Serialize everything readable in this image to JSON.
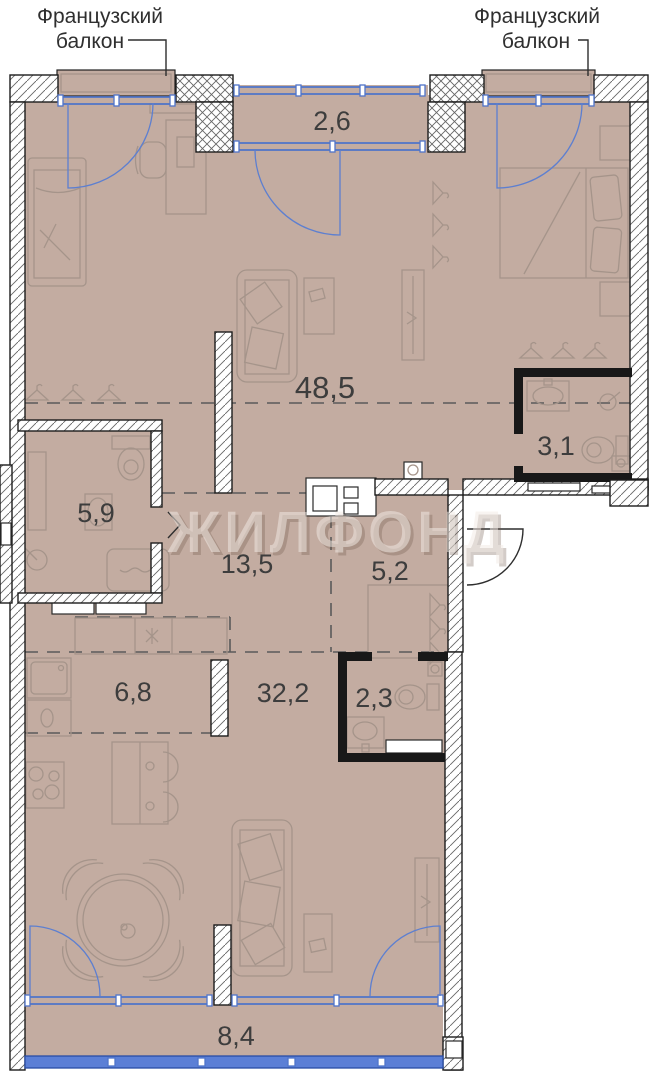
{
  "watermark": {
    "text": "ЖИЛФОНД"
  },
  "balcony_label_left": {
    "line1": "Французский",
    "line2": "балкон"
  },
  "balcony_label_right": {
    "line1": "Французский",
    "line2": "балкон"
  },
  "rooms": [
    {
      "name": "loggia-top",
      "area": "2,6"
    },
    {
      "name": "living-open-plan",
      "area": "48,5"
    },
    {
      "name": "bathroom-right",
      "area": "3,1"
    },
    {
      "name": "bathroom-left",
      "area": "5,9"
    },
    {
      "name": "corridor",
      "area": "13,5"
    },
    {
      "name": "hallway",
      "area": "5,2"
    },
    {
      "name": "kitchen",
      "area": "6,8"
    },
    {
      "name": "living-lower",
      "area": "32,2"
    },
    {
      "name": "wc-small",
      "area": "2,3"
    },
    {
      "name": "balcony-bottom",
      "area": "8,4"
    }
  ],
  "colors": {
    "floor": "#c3aca1",
    "window_blue": "#4f74c9",
    "glazing_fill": "#5b7fd6",
    "wall_outline": "#1d1d1d",
    "furniture_stroke": "#a5948a",
    "label_text": "#3d3d3d"
  }
}
